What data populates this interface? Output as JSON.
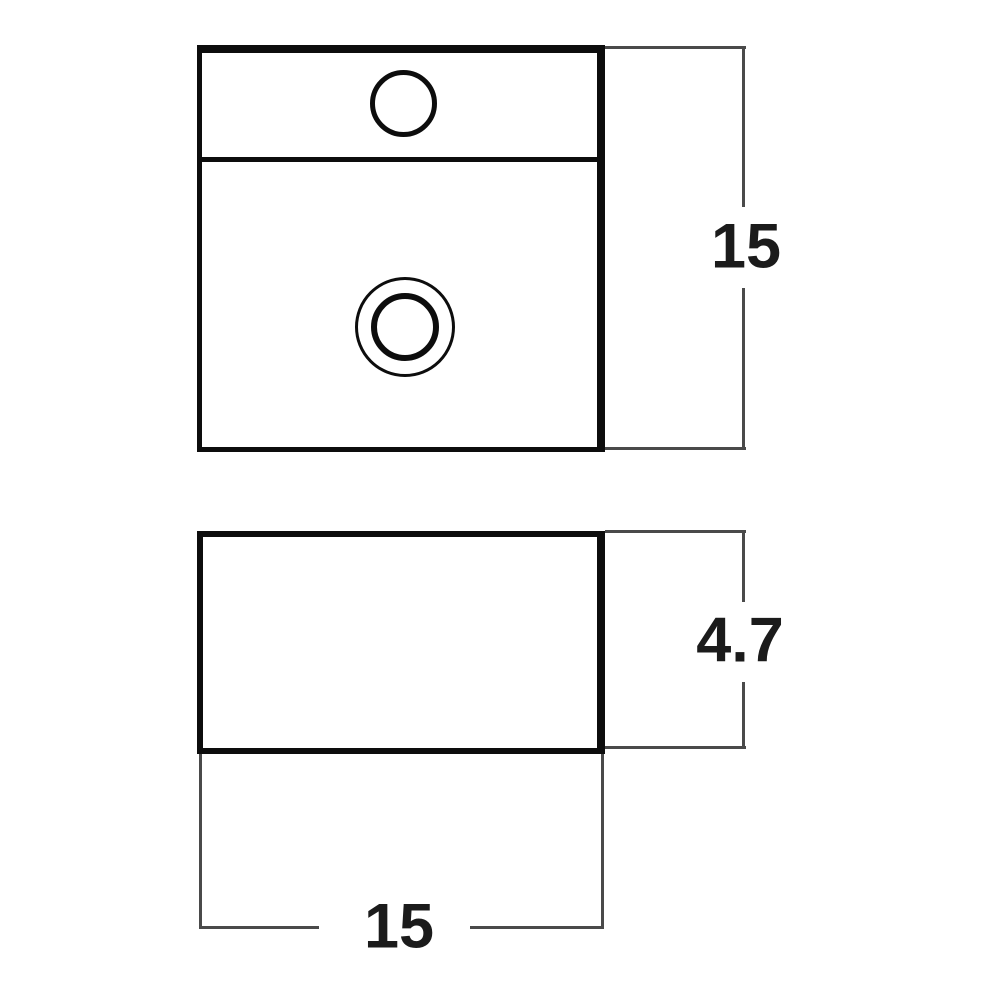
{
  "colors": {
    "background": "#ffffff",
    "outline": "#0d0d0d",
    "dimension_line": "#4a4a4a",
    "label_text": "#1b1b1b"
  },
  "dimensions": {
    "top_view_height": "15",
    "front_view_depth": "4.7",
    "front_view_width": "15"
  }
}
